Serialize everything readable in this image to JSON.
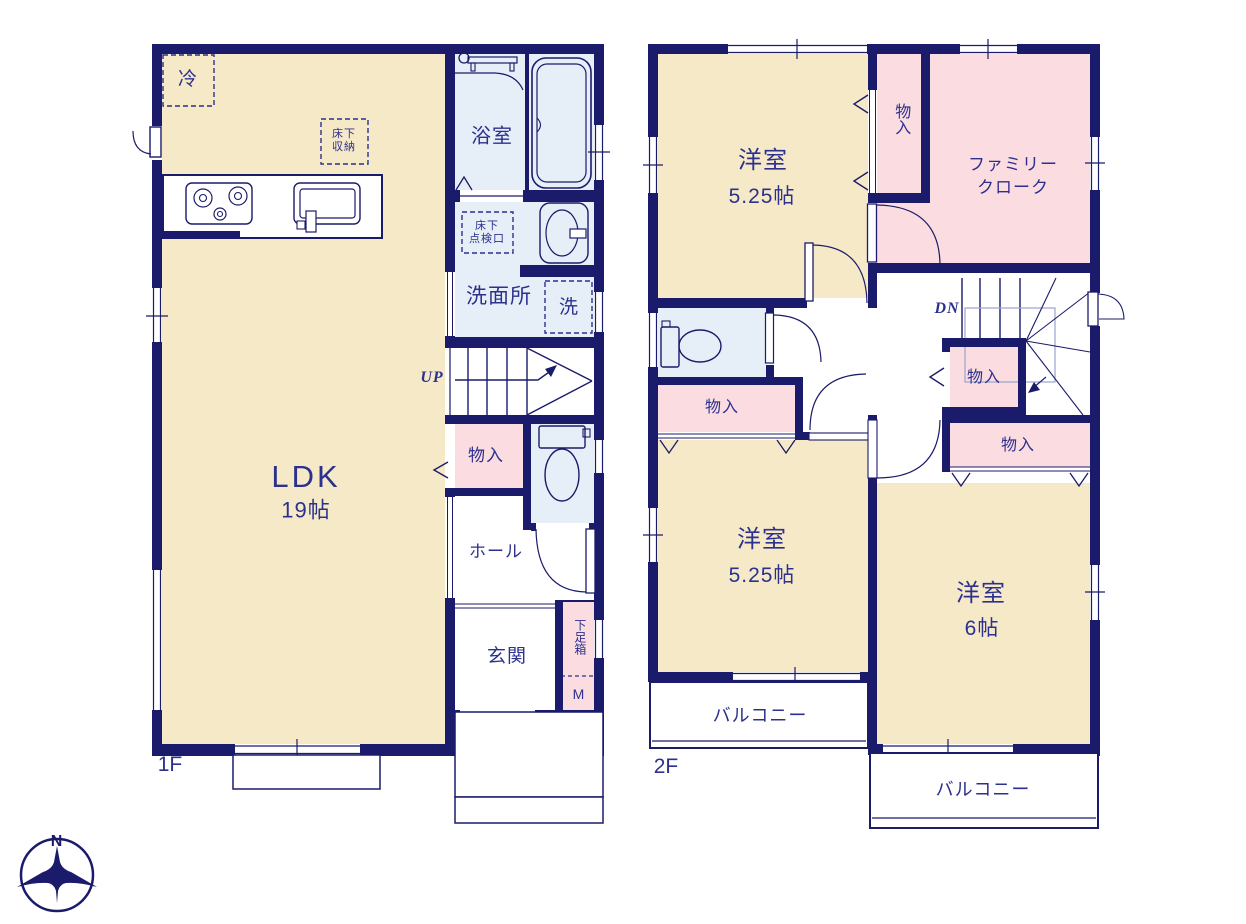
{
  "title": "2-story house floor plan",
  "colors": {
    "wall_navy": "#1b1b6b",
    "text_navy": "#2c318e",
    "room_cream": "#f6e9c8",
    "closet_pink": "#fbdce1",
    "wet_area_blue": "#e6eef7",
    "stair_guide": "#9aa3cc"
  },
  "floor1": {
    "floor_label": "1F",
    "rooms": {
      "ldk": {
        "name": "LDK",
        "size": "19帖"
      },
      "bathroom": "浴室",
      "washroom": "洗面所",
      "hall": "ホール",
      "entrance": "玄関"
    },
    "features": {
      "refrigerator": "冷",
      "underfloor_storage": "床下\n収納",
      "underfloor_access": "床下\n点検口",
      "washer": "洗",
      "storage": "物入",
      "shoe_box": "下足箱",
      "meter": "M",
      "stair_direction": "UP"
    }
  },
  "floor2": {
    "floor_label": "2F",
    "rooms": {
      "bedroom_north": {
        "name": "洋室",
        "size": "5.25帖"
      },
      "bedroom_southwest": {
        "name": "洋室",
        "size": "5.25帖"
      },
      "bedroom_southeast": {
        "name": "洋室",
        "size": "6帖"
      },
      "family_closet": "ファミリー\nクローク"
    },
    "features": {
      "closet_north": "物入",
      "closet_west": "物入",
      "closet_center": "物入",
      "closet_east": "物入",
      "balcony_west": "バルコニー",
      "balcony_south": "バルコニー",
      "stair_direction": "DN"
    }
  },
  "compass": {
    "north": "N"
  }
}
